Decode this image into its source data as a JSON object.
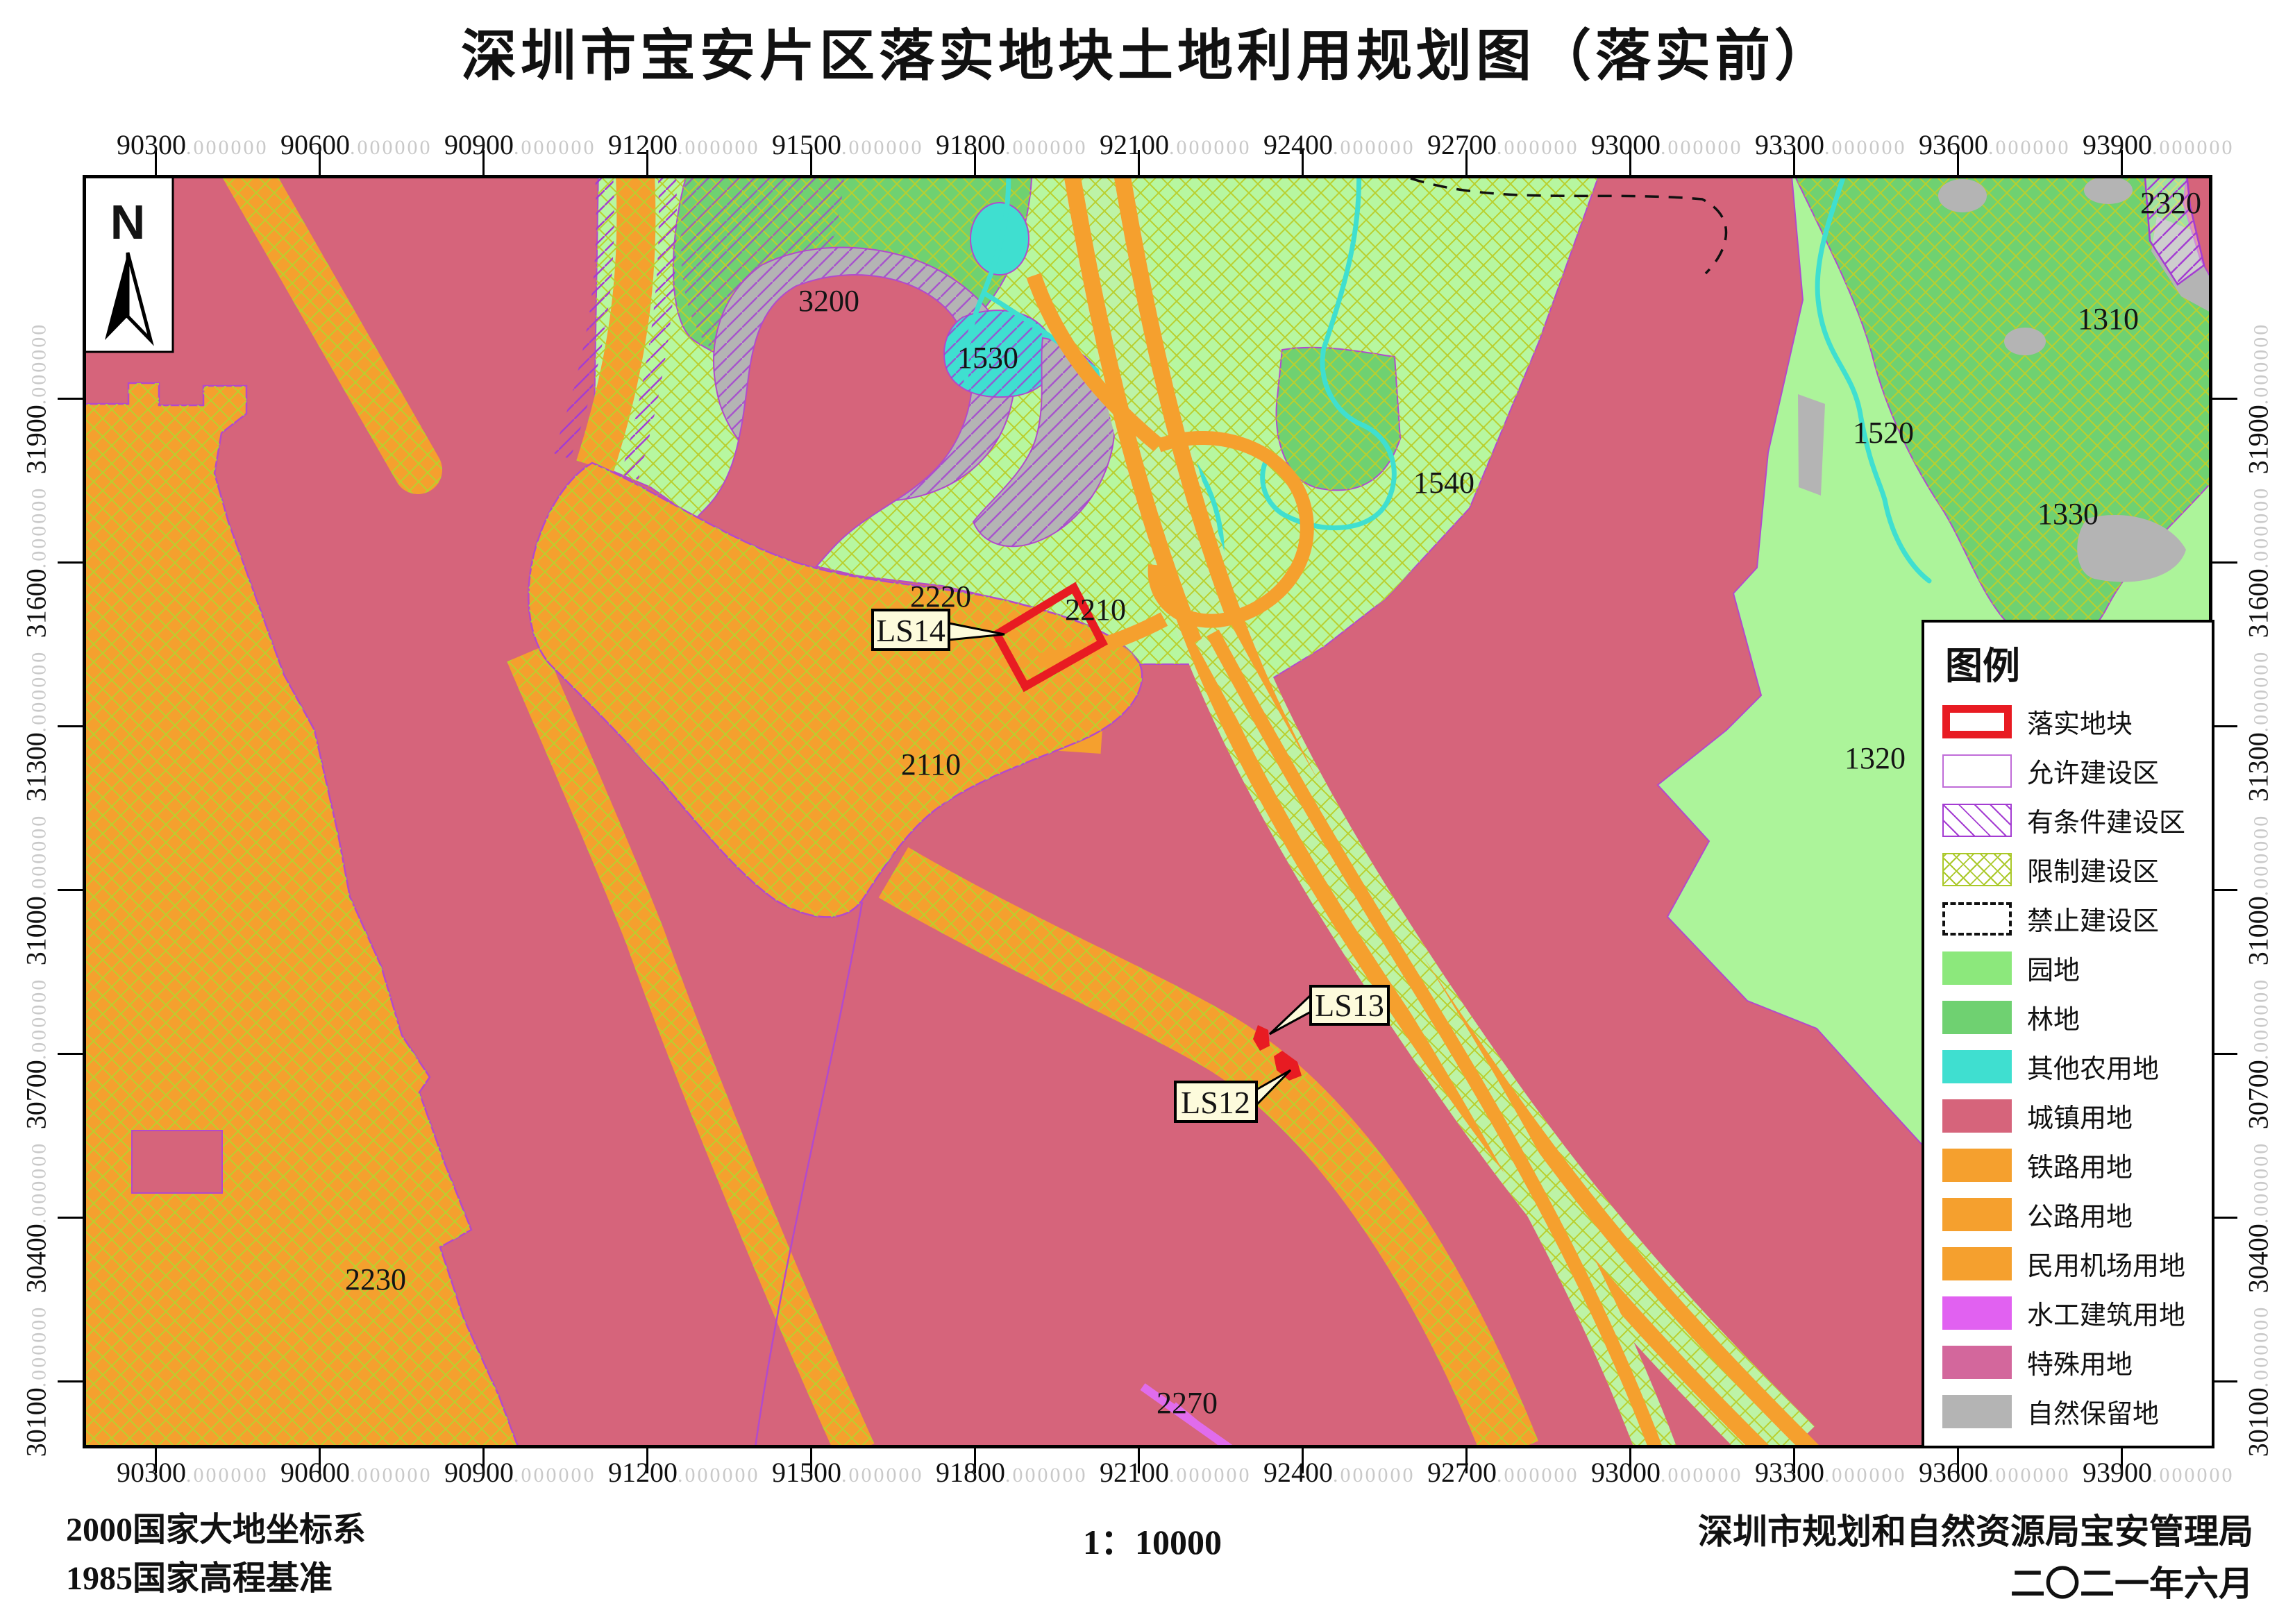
{
  "title": "深圳市宝安片区落实地块土地利用规划图（落实前）",
  "north": {
    "label": "N"
  },
  "axes": {
    "x_labels": [
      "90300",
      "90600",
      "90900",
      "91200",
      "91500",
      "91800",
      "92100",
      "92400",
      "92700",
      "93000",
      "93300",
      "93600",
      "93900"
    ],
    "y_labels": [
      "31900",
      "31600",
      "31300",
      "31000",
      "30700",
      "30400",
      "30100"
    ],
    "decimal_suffix": ".000000"
  },
  "map": {
    "area_labels": [
      "3200",
      "1530",
      "1540",
      "2320",
      "1310",
      "1520",
      "1330",
      "1320",
      "2220",
      "2210",
      "2110",
      "2230",
      "2270"
    ],
    "callouts": [
      "LS14",
      "LS13",
      "LS12"
    ]
  },
  "legend": {
    "title": "图例",
    "items": [
      {
        "label": "落实地块",
        "swatch": "red-outline",
        "color": "#e81b22"
      },
      {
        "label": "允许建设区",
        "swatch": "thin-purple-outline",
        "color": "#c06cd8"
      },
      {
        "label": "有条件建设区",
        "swatch": "purple-diagonal-hatch",
        "color": "#a43cd2"
      },
      {
        "label": "限制建设区",
        "swatch": "green-crosshatch",
        "color": "#aac828"
      },
      {
        "label": "禁止建设区",
        "swatch": "black-dashed-outline",
        "color": "#111111"
      },
      {
        "label": "园地",
        "swatch": "fill",
        "color": "#8ce87c"
      },
      {
        "label": "林地",
        "swatch": "fill",
        "color": "#6fd171"
      },
      {
        "label": "其他农用地",
        "swatch": "fill",
        "color": "#3fdfd0"
      },
      {
        "label": "城镇用地",
        "swatch": "fill",
        "color": "#d6647b"
      },
      {
        "label": "铁路用地",
        "swatch": "fill",
        "color": "#f5a02e"
      },
      {
        "label": "公路用地",
        "swatch": "fill",
        "color": "#f5a02e"
      },
      {
        "label": "民用机场用地",
        "swatch": "fill",
        "color": "#f5a02e"
      },
      {
        "label": "水工建筑用地",
        "swatch": "fill",
        "color": "#e161f1"
      },
      {
        "label": "特殊用地",
        "swatch": "fill",
        "color": "#d3679c"
      },
      {
        "label": "自然保留地",
        "swatch": "fill",
        "color": "#b4b4b4"
      }
    ]
  },
  "footer": {
    "datum_line1": "2000国家大地坐标系",
    "datum_line2": "1985国家高程基准",
    "scale_text": "1：10000",
    "agency": "深圳市规划和自然资源局宝安管理局",
    "date": "二〇二一年六月"
  }
}
